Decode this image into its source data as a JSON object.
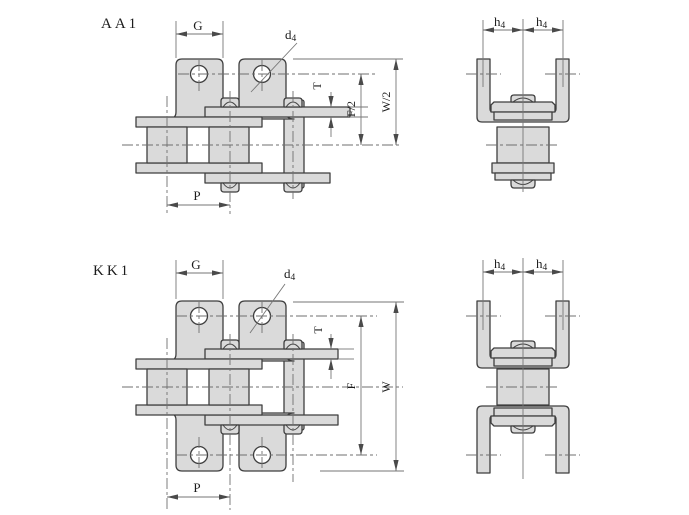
{
  "page": {
    "background": "#ffffff"
  },
  "styles": {
    "part_fill": "#dadada",
    "outline_color": "#3f3f3f",
    "dim_line_color": "#767676",
    "centerline_color": "#6f6f6f",
    "text_color": "#1c1c1c"
  },
  "views": {
    "aa1_side": {
      "title": "AA1",
      "dim_g": "G",
      "dim_d4_main": "d",
      "dim_d4_sub": "4",
      "dim_t": "T",
      "dim_f_half": "F/2",
      "dim_w_half": "W/2",
      "dim_p": "P"
    },
    "aa1_end": {
      "dim_h4_left_main": "h",
      "dim_h4_left_sub": "4",
      "dim_h4_right_main": "h",
      "dim_h4_right_sub": "4"
    },
    "kk1_side": {
      "title": "KK1",
      "dim_g": "G",
      "dim_d4_main": "d",
      "dim_d4_sub": "4",
      "dim_t": "T",
      "dim_f": "F",
      "dim_w": "W",
      "dim_p": "P"
    },
    "kk1_end": {
      "dim_h4_left_main": "h",
      "dim_h4_left_sub": "4",
      "dim_h4_right_main": "h",
      "dim_h4_right_sub": "4"
    }
  }
}
